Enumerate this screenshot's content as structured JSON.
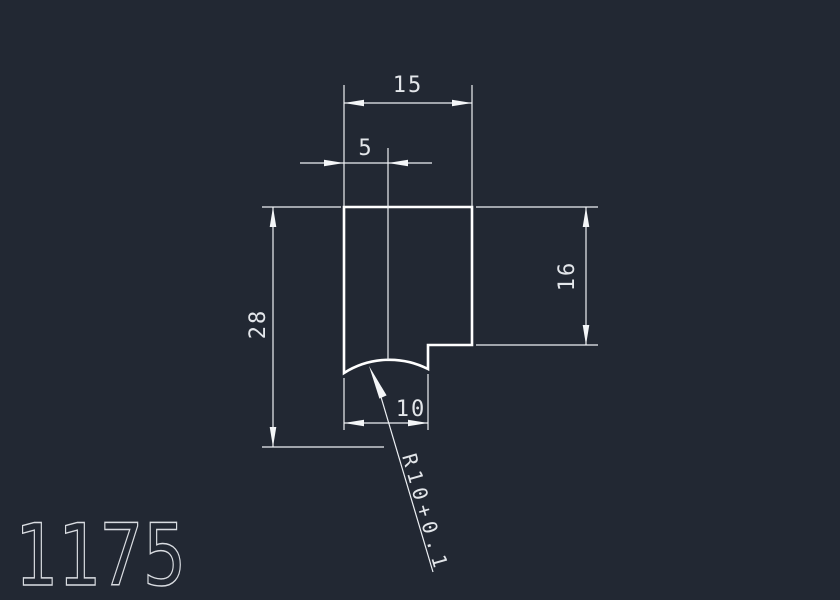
{
  "part_number": "1175",
  "labels": {
    "dim_top_width": "15",
    "dim_center_offset": "5",
    "dim_overall_height": "28",
    "dim_right_height": "16",
    "dim_bottom_width": "10",
    "radius_callout": "R10+0.1"
  },
  "colors": {
    "background": "#222833",
    "profile_outline": "#ffffff",
    "dimension_lines": "#edf0f4",
    "dimension_text": "#e3e6ea",
    "part_number_text": "#d9dce1"
  }
}
